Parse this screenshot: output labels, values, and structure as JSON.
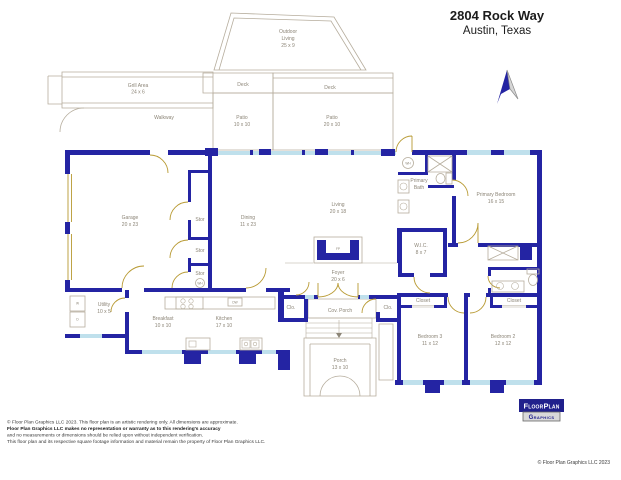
{
  "header": {
    "title": "2804 Rock Way",
    "subtitle": "Austin, Texas"
  },
  "rooms": {
    "outdoor_living": {
      "name": "Outdoor",
      "name2": "Living",
      "dims": "25 x 9"
    },
    "grill_area": {
      "name": "Grill Area",
      "dims": "24 x 6"
    },
    "walkway": {
      "name": "Walkway"
    },
    "deck_west": {
      "name": "Deck"
    },
    "deck_east": {
      "name": "Deck"
    },
    "patio_west": {
      "name": "Patio",
      "dims": "10 x 10"
    },
    "patio_east": {
      "name": "Patio",
      "dims": "20 x 10"
    },
    "garage": {
      "name": "Garage",
      "dims": "20 x 23"
    },
    "stor_1": {
      "name": "Stor"
    },
    "stor_2": {
      "name": "Stor"
    },
    "stor_3": {
      "name": "Stor"
    },
    "dining": {
      "name": "Dining",
      "dims": "11 x 23"
    },
    "living": {
      "name": "Living",
      "dims": "20 x 18"
    },
    "primary_bath": {
      "name": "Primary",
      "name2": "Bath"
    },
    "primary_bedroom": {
      "name": "Primary Bedroom",
      "dims": "16 x 15"
    },
    "wic": {
      "name": "W.I.C.",
      "dims": "8 x 7"
    },
    "utility": {
      "name": "Utility",
      "dims": "10 x 5"
    },
    "breakfast": {
      "name": "Breakfast",
      "dims": "10 x 10"
    },
    "kitchen": {
      "name": "Kitchen",
      "dims": "17 x 10"
    },
    "foyer": {
      "name": "Foyer",
      "dims": "20 x 6"
    },
    "clo_west": {
      "name": "Clo."
    },
    "clo_east": {
      "name": "Clo."
    },
    "cov_porch": {
      "name": "Cov. Porch"
    },
    "porch": {
      "name": "Porch",
      "dims": "13 x 10"
    },
    "closet_bed3": {
      "name": "Closet"
    },
    "closet_bed2": {
      "name": "Closet"
    },
    "bedroom_3": {
      "name": "Bedroom 3",
      "dims": "11 x 12"
    },
    "bedroom_2": {
      "name": "Bedroom 2",
      "dims": "12 x 12"
    }
  },
  "fixtures": {
    "washer": "W",
    "dryer": "D",
    "dishwasher": "DW",
    "water_heater": "WH",
    "fireplace": "FP"
  },
  "logo": {
    "line1": "FloorPlan",
    "line2": "Graphics"
  },
  "footer": {
    "disclaimer_line1": "© Floor Plan Graphics LLC 2023. This floor plan is an artistic rendering only. All dimensions are approximate.",
    "disclaimer_line2": "Floor Plan Graphics LLC makes no representation or warranty as to this rendering's accuracy",
    "disclaimer_line3": "and no measurements or dimensions should be relied upon without independent verification.",
    "disclaimer_line4": "This floor plan and its respective square footage information and material remain the property of Floor Plan Graphics LLC.",
    "copyright": "© Floor Plan Graphics LLC 2023"
  },
  "colors": {
    "wall": "#2424a3",
    "window": "#bfe0ec",
    "door": "#b89a33",
    "outline": "#b6ad9d",
    "label": "#8c8577"
  }
}
